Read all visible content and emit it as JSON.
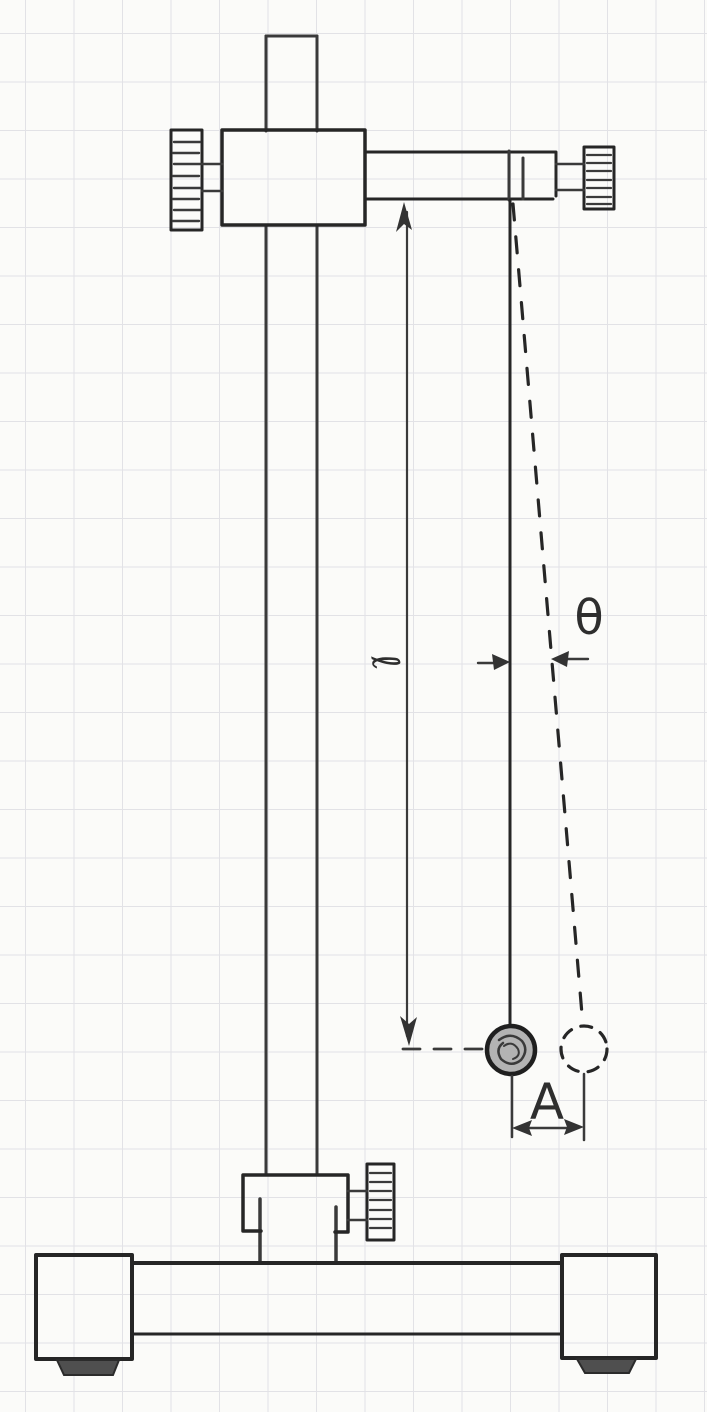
{
  "diagram": {
    "subject": "simple pendulum hanging from a laboratory stand",
    "medium": "pencil sketch on graph paper",
    "labels": {
      "pendulum_length": "ℓ",
      "displacement_angle": "θ",
      "amplitude": "A"
    },
    "colors": {
      "paper": "#fbfbf9",
      "grid_line": "#e2e2e6",
      "pencil": "#3a3a3a",
      "pencil_dark": "#262626",
      "bob_fill": "#b3b3b3",
      "foot_pad": "#4f4f4f"
    }
  }
}
